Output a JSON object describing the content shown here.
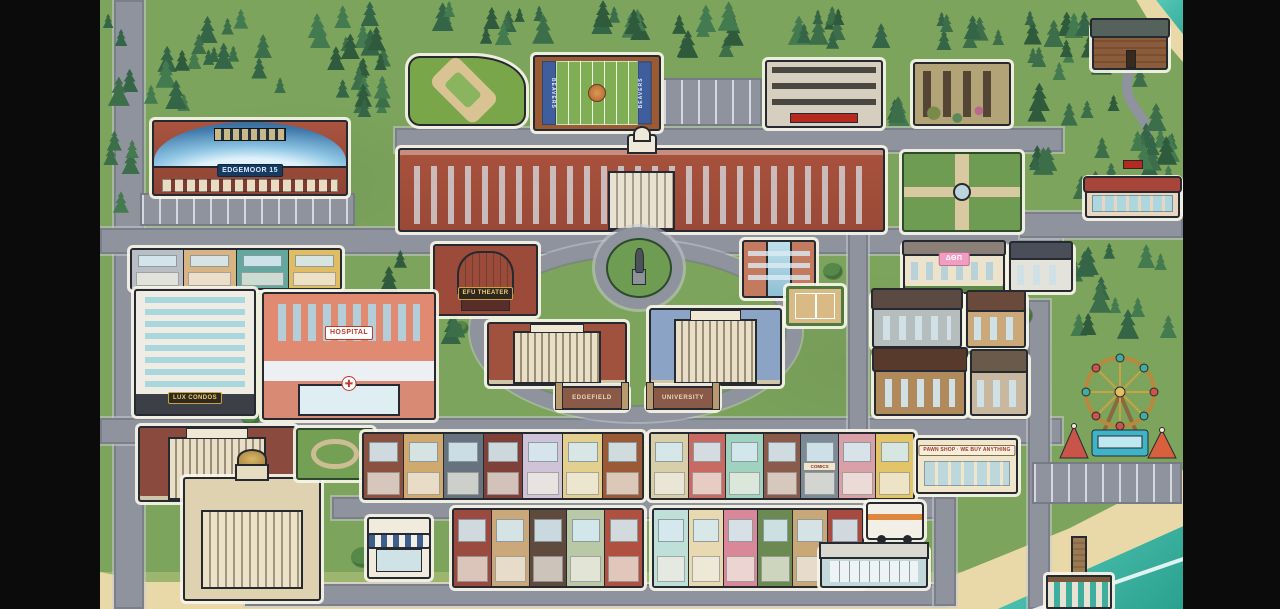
{
  "scene": {
    "width": 1280,
    "height": 609,
    "letterbox": "#0b0b0b"
  },
  "palette": {
    "grass": "#7ca45c",
    "road": "#8e939d",
    "sidewalk": "#c8cbd2",
    "outline": "#262a30",
    "halo": "#f7f4e8",
    "sand": "#ead9a8",
    "ocean": "#4cc8b6",
    "ocean_deep": "#2aa08f",
    "pine_dark": "#2f5a3b",
    "pine_mid": "#3c6e49",
    "pine_light": "#447a50",
    "brick": "#a7523d",
    "cream": "#e9e2d2",
    "accent_red": "#c0392b",
    "accent_gold": "#f2cf6a"
  },
  "map": {
    "ring": {
      "name": "campus-loop-road",
      "x": 470,
      "y": 240,
      "w": 332,
      "h": 182
    },
    "roads": [
      {
        "name": "left-avenue",
        "x": 114,
        "y": 0,
        "w": 30,
        "h": 609
      },
      {
        "name": "campus-north-street",
        "x": 395,
        "y": 128,
        "w": 668,
        "h": 24
      },
      {
        "name": "main-street-upper",
        "x": 100,
        "y": 228,
        "w": 962,
        "h": 26
      },
      {
        "name": "northeast-road",
        "x": 1020,
        "y": 212,
        "w": 163,
        "h": 26
      },
      {
        "name": "main-street-lower",
        "x": 100,
        "y": 418,
        "w": 962,
        "h": 26
      },
      {
        "name": "shops-street",
        "x": 332,
        "y": 497,
        "w": 610,
        "h": 22
      },
      {
        "name": "boardwalk-street",
        "x": 245,
        "y": 584,
        "w": 700,
        "h": 22
      },
      {
        "name": "east-cross-street",
        "x": 848,
        "y": 228,
        "w": 20,
        "h": 214
      },
      {
        "name": "market-cross-street",
        "x": 934,
        "y": 497,
        "w": 22,
        "h": 109
      },
      {
        "name": "pier-road",
        "x": 1028,
        "y": 300,
        "w": 22,
        "h": 309
      }
    ],
    "parking": [
      {
        "name": "arena-parking-lot",
        "x": 140,
        "y": 193,
        "w": 215,
        "h": 33
      },
      {
        "name": "field-parking-lot",
        "x": 662,
        "y": 78,
        "w": 100,
        "h": 48
      },
      {
        "name": "carnival-parking-lot",
        "x": 1032,
        "y": 462,
        "w": 150,
        "h": 42
      }
    ],
    "buildings": [
      {
        "name": "edgemoor-cinema",
        "kind": "arena",
        "x": 152,
        "y": 120,
        "w": 196,
        "h": 76,
        "label": "EDGEMOOR 15"
      },
      {
        "name": "baseball-field",
        "kind": "baseball",
        "x": 408,
        "y": 56,
        "w": 118,
        "h": 70
      },
      {
        "name": "football-field",
        "kind": "football",
        "x": 533,
        "y": 55,
        "w": 128,
        "h": 76,
        "end": "BEAVERS"
      },
      {
        "name": "parking-garage",
        "kind": "garage",
        "x": 765,
        "y": 60,
        "w": 118,
        "h": 68
      },
      {
        "name": "abandoned-building",
        "kind": "ruin",
        "x": 913,
        "y": 62,
        "w": 98,
        "h": 64
      },
      {
        "name": "campus-main-hall",
        "kind": "grandhall",
        "x": 398,
        "y": 148,
        "w": 487,
        "h": 84
      },
      {
        "name": "formal-garden",
        "kind": "garden",
        "x": 902,
        "y": 152,
        "w": 120,
        "h": 80
      },
      {
        "name": "diner",
        "kind": "diner",
        "x": 1085,
        "y": 178,
        "w": 95,
        "h": 40
      },
      {
        "name": "forest-cabin",
        "kind": "cabin",
        "x": 1092,
        "y": 26,
        "w": 76,
        "h": 44
      },
      {
        "name": "houses-row",
        "kind": "houserow",
        "x": 130,
        "y": 248,
        "w": 212,
        "h": 42,
        "units": [
          {
            "c": "#b9bec4"
          },
          {
            "c": "#d9b483"
          },
          {
            "c": "#63a89e"
          },
          {
            "c": "#e0bc62"
          }
        ]
      },
      {
        "name": "efu-theater",
        "kind": "theater",
        "x": 433,
        "y": 244,
        "w": 105,
        "h": 72,
        "label": "EFU THEATER"
      },
      {
        "name": "statue-plaza",
        "kind": "plaza",
        "x": 606,
        "y": 238,
        "w": 66,
        "h": 60
      },
      {
        "name": "science-building",
        "kind": "modern",
        "x": 742,
        "y": 240,
        "w": 74,
        "h": 58
      },
      {
        "name": "tennis-court",
        "kind": "court",
        "x": 786,
        "y": 286,
        "w": 58,
        "h": 40
      },
      {
        "name": "sorority-house",
        "kind": "mansion",
        "x": 903,
        "y": 244,
        "w": 102,
        "h": 50,
        "label": "ΔΘΠ"
      },
      {
        "name": "white-house",
        "kind": "house",
        "x": 1009,
        "y": 246,
        "w": 64,
        "h": 46,
        "colors": [
          "#e3e3dc",
          "#4a4e58"
        ]
      },
      {
        "name": "lux-condos",
        "kind": "tower",
        "x": 134,
        "y": 289,
        "w": 122,
        "h": 127,
        "label": "LUX CONDOS"
      },
      {
        "name": "hospital",
        "kind": "hospital",
        "x": 262,
        "y": 292,
        "w": 174,
        "h": 128,
        "label": "HOSPITAL",
        "icon": "✚"
      },
      {
        "name": "edgefield-hall",
        "kind": "classical",
        "x": 487,
        "y": 322,
        "w": 140,
        "h": 64,
        "colors": [
          "#a0523f"
        ]
      },
      {
        "name": "edgefield-arch-sign",
        "kind": "archsign",
        "x": 556,
        "y": 386,
        "w": 72,
        "h": 24,
        "label": "EDGEFIELD"
      },
      {
        "name": "university-hall",
        "kind": "classical",
        "x": 649,
        "y": 308,
        "w": 133,
        "h": 78,
        "colors": [
          "#8ba3c4"
        ]
      },
      {
        "name": "university-arch-sign",
        "kind": "archsign",
        "x": 647,
        "y": 386,
        "w": 72,
        "h": 24,
        "label": "UNIVERSITY"
      },
      {
        "name": "craftsman-house",
        "kind": "house",
        "x": 872,
        "y": 294,
        "w": 90,
        "h": 54,
        "colors": [
          "#b6bdbd",
          "#5a4a42"
        ]
      },
      {
        "name": "garden-house",
        "kind": "house",
        "x": 966,
        "y": 296,
        "w": 60,
        "h": 52,
        "colors": [
          "#cba87a",
          "#6a4a3a"
        ]
      },
      {
        "name": "tudor-house",
        "kind": "house",
        "x": 874,
        "y": 354,
        "w": 92,
        "h": 62,
        "colors": [
          "#b08a5a",
          "#573a2c"
        ]
      },
      {
        "name": "stone-house",
        "kind": "house",
        "x": 970,
        "y": 356,
        "w": 58,
        "h": 60,
        "colors": [
          "#c9b8a0",
          "#6a5a4a"
        ]
      },
      {
        "name": "carnival",
        "kind": "carnival",
        "x": 1056,
        "y": 348,
        "w": 128,
        "h": 116
      },
      {
        "name": "bank",
        "kind": "classical",
        "x": 138,
        "y": 426,
        "w": 158,
        "h": 76,
        "colors": [
          "#8a4a3e"
        ]
      },
      {
        "name": "city-hall",
        "kind": "domed",
        "x": 183,
        "y": 477,
        "w": 138,
        "h": 124
      },
      {
        "name": "mini-park",
        "kind": "park",
        "x": 296,
        "y": 428,
        "w": 78,
        "h": 52
      },
      {
        "name": "shop-row-west",
        "kind": "shoprow",
        "x": 362,
        "y": 432,
        "w": 282,
        "h": 68,
        "units": [
          {
            "c": "#8a5040"
          },
          {
            "c": "#cfa96e"
          },
          {
            "c": "#66737e"
          },
          {
            "c": "#7e4038"
          },
          {
            "c": "#cfc3d8"
          },
          {
            "c": "#e3cf8e"
          },
          {
            "c": "#9a5a36"
          }
        ]
      },
      {
        "name": "shop-row-east",
        "kind": "shoprow",
        "x": 649,
        "y": 432,
        "w": 266,
        "h": 68,
        "units": [
          {
            "c": "#d8cfa8"
          },
          {
            "c": "#c96a62"
          },
          {
            "c": "#9fd3c0"
          },
          {
            "c": "#8a5a4a"
          },
          {
            "c": "#7c8a96",
            "label": "COMICS"
          },
          {
            "c": "#d9a0a8"
          },
          {
            "c": "#e3c568"
          }
        ]
      },
      {
        "name": "pawn-shop",
        "kind": "flat",
        "x": 916,
        "y": 438,
        "w": 102,
        "h": 56,
        "label": "PAWN SHOP · WE BUY ANYTHING"
      },
      {
        "name": "corner-cafe",
        "kind": "cafe",
        "x": 367,
        "y": 517,
        "w": 64,
        "h": 62
      },
      {
        "name": "shop-row-south-west",
        "kind": "shoprow",
        "x": 452,
        "y": 508,
        "w": 192,
        "h": 80,
        "units": [
          {
            "c": "#9a4a3e"
          },
          {
            "c": "#caa87a"
          },
          {
            "c": "#5f4a3e"
          },
          {
            "c": "#b9c9a8"
          },
          {
            "c": "#b05040"
          }
        ]
      },
      {
        "name": "shop-row-south-east",
        "kind": "shoprow",
        "x": 652,
        "y": 508,
        "w": 212,
        "h": 80,
        "units": [
          {
            "c": "#bfe0d8"
          },
          {
            "c": "#e8d9b0"
          },
          {
            "c": "#d9889a"
          },
          {
            "c": "#6a8a52"
          },
          {
            "c": "#c9a878"
          },
          {
            "c": "#a84a40"
          }
        ]
      },
      {
        "name": "food-truck",
        "kind": "truck",
        "x": 866,
        "y": 502,
        "w": 58,
        "h": 38
      },
      {
        "name": "transit-stop",
        "kind": "station",
        "x": 820,
        "y": 548,
        "w": 108,
        "h": 40
      },
      {
        "name": "beach-pier",
        "kind": "pier",
        "x": 1046,
        "y": 536,
        "w": 66,
        "h": 73
      }
    ]
  }
}
